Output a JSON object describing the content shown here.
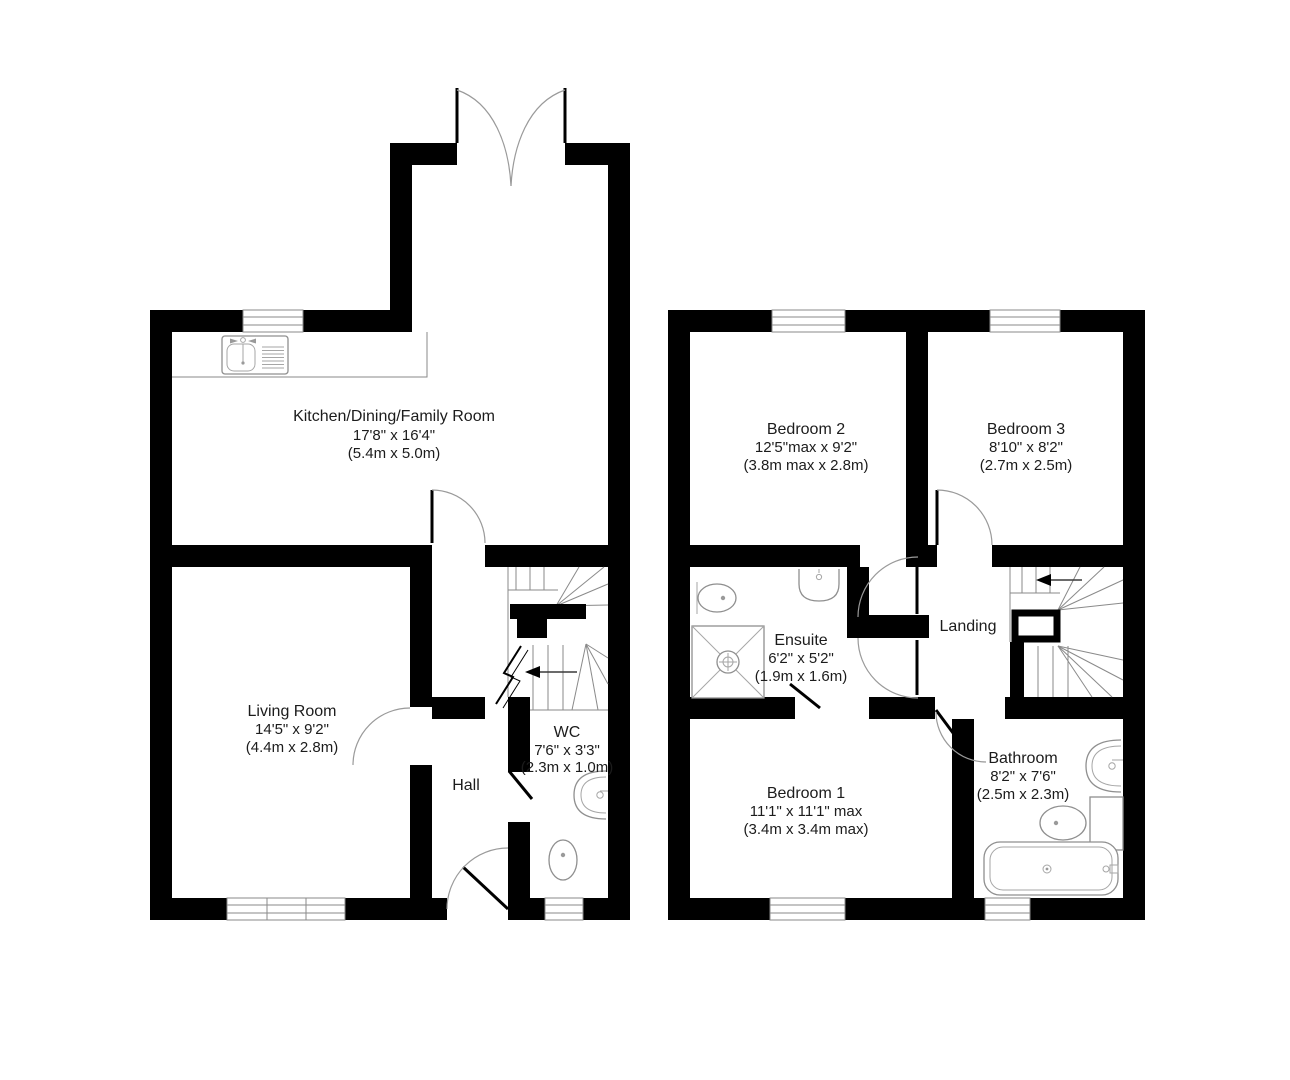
{
  "floors": {
    "ground": {
      "rooms": {
        "kitchen": {
          "name": "Kitchen/Dining/Family Room",
          "imperial": "17'8\" x 16'4\"",
          "metric": "(5.4m x 5.0m)"
        },
        "living_room": {
          "name": "Living Room",
          "imperial": "14'5\" x 9'2\"",
          "metric": "(4.4m x 2.8m)"
        },
        "wc": {
          "name": "WC",
          "imperial": "7'6\" x 3'3\"",
          "metric": "(2.3m x 1.0m)"
        },
        "hall": {
          "name": "Hall"
        }
      }
    },
    "first": {
      "rooms": {
        "bedroom2": {
          "name": "Bedroom 2",
          "imperial": "12'5\"max x 9'2\"",
          "metric": "(3.8m max x 2.8m)"
        },
        "bedroom3": {
          "name": "Bedroom 3",
          "imperial": "8'10\" x 8'2\"",
          "metric": "(2.7m x 2.5m)"
        },
        "ensuite": {
          "name": "Ensuite",
          "imperial": "6'2\" x 5'2\"",
          "metric": "(1.9m x 1.6m)"
        },
        "landing": {
          "name": "Landing"
        },
        "bedroom1": {
          "name": "Bedroom 1",
          "imperial": "11'1\" x 11'1\" max",
          "metric": "(3.4m x 3.4m max)"
        },
        "bathroom": {
          "name": "Bathroom",
          "imperial": "8'2\" x 7'6\"",
          "metric": "(2.5m x 2.3m)"
        }
      }
    }
  },
  "colors": {
    "wall": "#000000",
    "line": "#8a8a8a",
    "background": "#ffffff",
    "text": "#1c1c1c"
  }
}
